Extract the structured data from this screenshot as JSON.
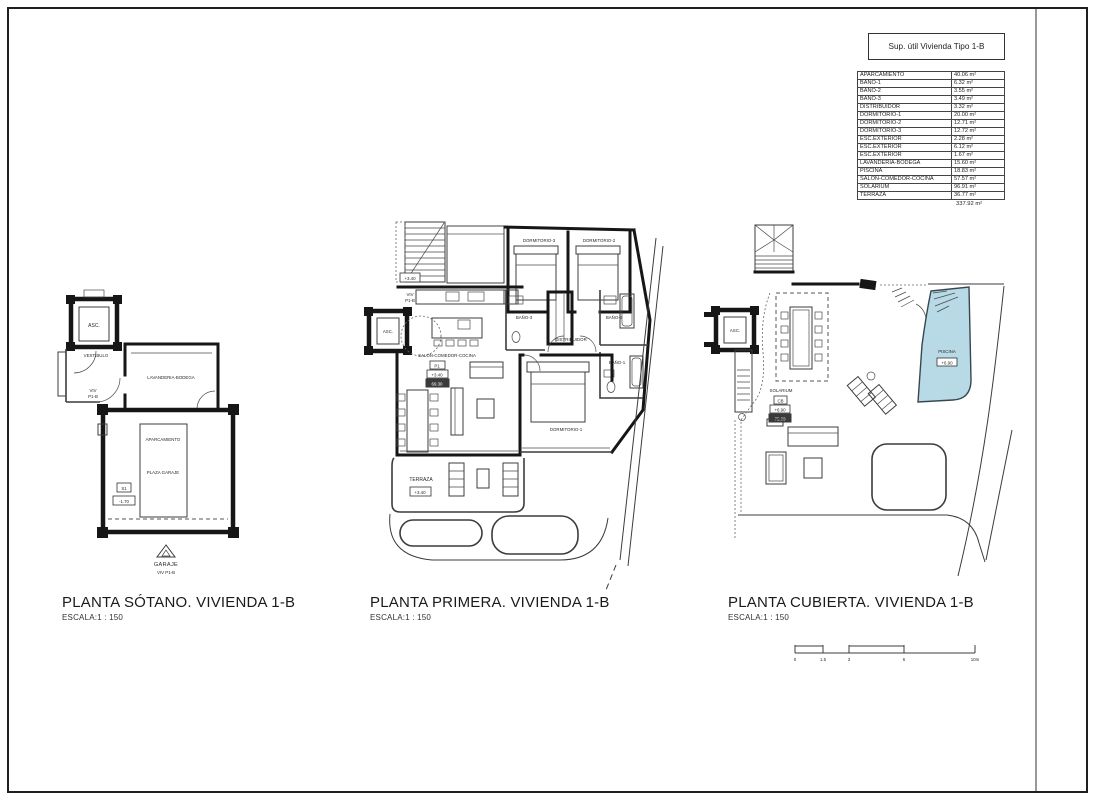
{
  "area_table": {
    "title": "Sup. útil Vivienda Tipo 1-B",
    "rows": [
      {
        "label": "APARCAMIENTO",
        "value": "40.06 m²"
      },
      {
        "label": "BAÑO-1",
        "value": "6.32 m²"
      },
      {
        "label": "BAÑO-2",
        "value": "3.55 m²"
      },
      {
        "label": "BAÑO-3",
        "value": "3.49 m²"
      },
      {
        "label": "DISTRIBUIDOR",
        "value": "3.32 m²"
      },
      {
        "label": "DORMITORIO-1",
        "value": "20.00 m²"
      },
      {
        "label": "DORMITORIO-2",
        "value": "12.71 m²"
      },
      {
        "label": "DORMITORIO-3",
        "value": "12.72 m²"
      },
      {
        "label": "ESC.EXTERIOR",
        "value": "2.28 m²"
      },
      {
        "label": "ESC.EXTERIOR",
        "value": "6.12 m²"
      },
      {
        "label": "ESC.EXTERIOR",
        "value": "1.67 m²"
      },
      {
        "label": "LAVANDERIA-BODEGA",
        "value": "15.60 m²"
      },
      {
        "label": "PISCINA",
        "value": "18.83 m²"
      },
      {
        "label": "SALÓN-COMEDOR-COCINA",
        "value": "57.57 m²"
      },
      {
        "label": "SOLARIUM",
        "value": "96.91 m²"
      },
      {
        "label": "TERRAZA",
        "value": "36.77 m²"
      }
    ],
    "total": "337.92 m²"
  },
  "plans": {
    "sotano": {
      "title": "PLANTA SÓTANO. VIVIENDA 1-B",
      "scale": "ESCALA:1 : 150",
      "labels": {
        "asc": "ASC.",
        "vestibulo": "VESTIBULO",
        "viv_top1": "VIV",
        "viv_top2": "P1-B",
        "lavanderia": "LAVANDERIA-BODEGA",
        "aparcamiento": "APARCAMIENTO",
        "plaza_garaje": "PLAZA GARAJE",
        "nivel_tag": "S1",
        "nivel": "-1.70",
        "garaje": "GARAJE",
        "viv_bottom": "VIV P1-B"
      }
    },
    "primera": {
      "title": "PLANTA PRIMERA. VIVIENDA 1-B",
      "scale": "ESCALA:1 : 150",
      "labels": {
        "viv1": "VIV",
        "viv2": "P1-B",
        "asc": "ASC.",
        "dorm3": "DORMITORIO-3",
        "dorm2": "DORMITORIO-2",
        "dorm1": "DORMITORIO-1",
        "bano3": "BAÑO-3",
        "bano2": "BAÑO-2",
        "bano1": "BAÑO-1",
        "distribuidor": "DISTRIBUIDOR",
        "salon": "SALÓN-COMEDOR-COCINA",
        "tag_p1": "P1",
        "nivel": "+3.40",
        "area": "69.30",
        "stair_nivel": "+3.40",
        "terraza": "TERRAZA",
        "terraza_nivel": "+3.40"
      }
    },
    "cubierta": {
      "title": "PLANTA CUBIERTA. VIVIENDA 1-B",
      "scale": "ESCALA:1 : 150",
      "labels": {
        "asc": "ASC.",
        "solarium": "SOLARIUM",
        "tag_cb": "CB",
        "nivel": "+6.90",
        "area": "75.80",
        "piscina": "PISCINA",
        "piscina_nivel": "+6.90"
      }
    }
  },
  "scale_bar": {
    "ticks": [
      "0",
      "1.5",
      "3",
      "6",
      "10m"
    ]
  },
  "colors": {
    "pool": "#b8d9e6",
    "thin_line": "#3c3c3c",
    "wall": "#161616",
    "border": "#1f1f1f"
  }
}
